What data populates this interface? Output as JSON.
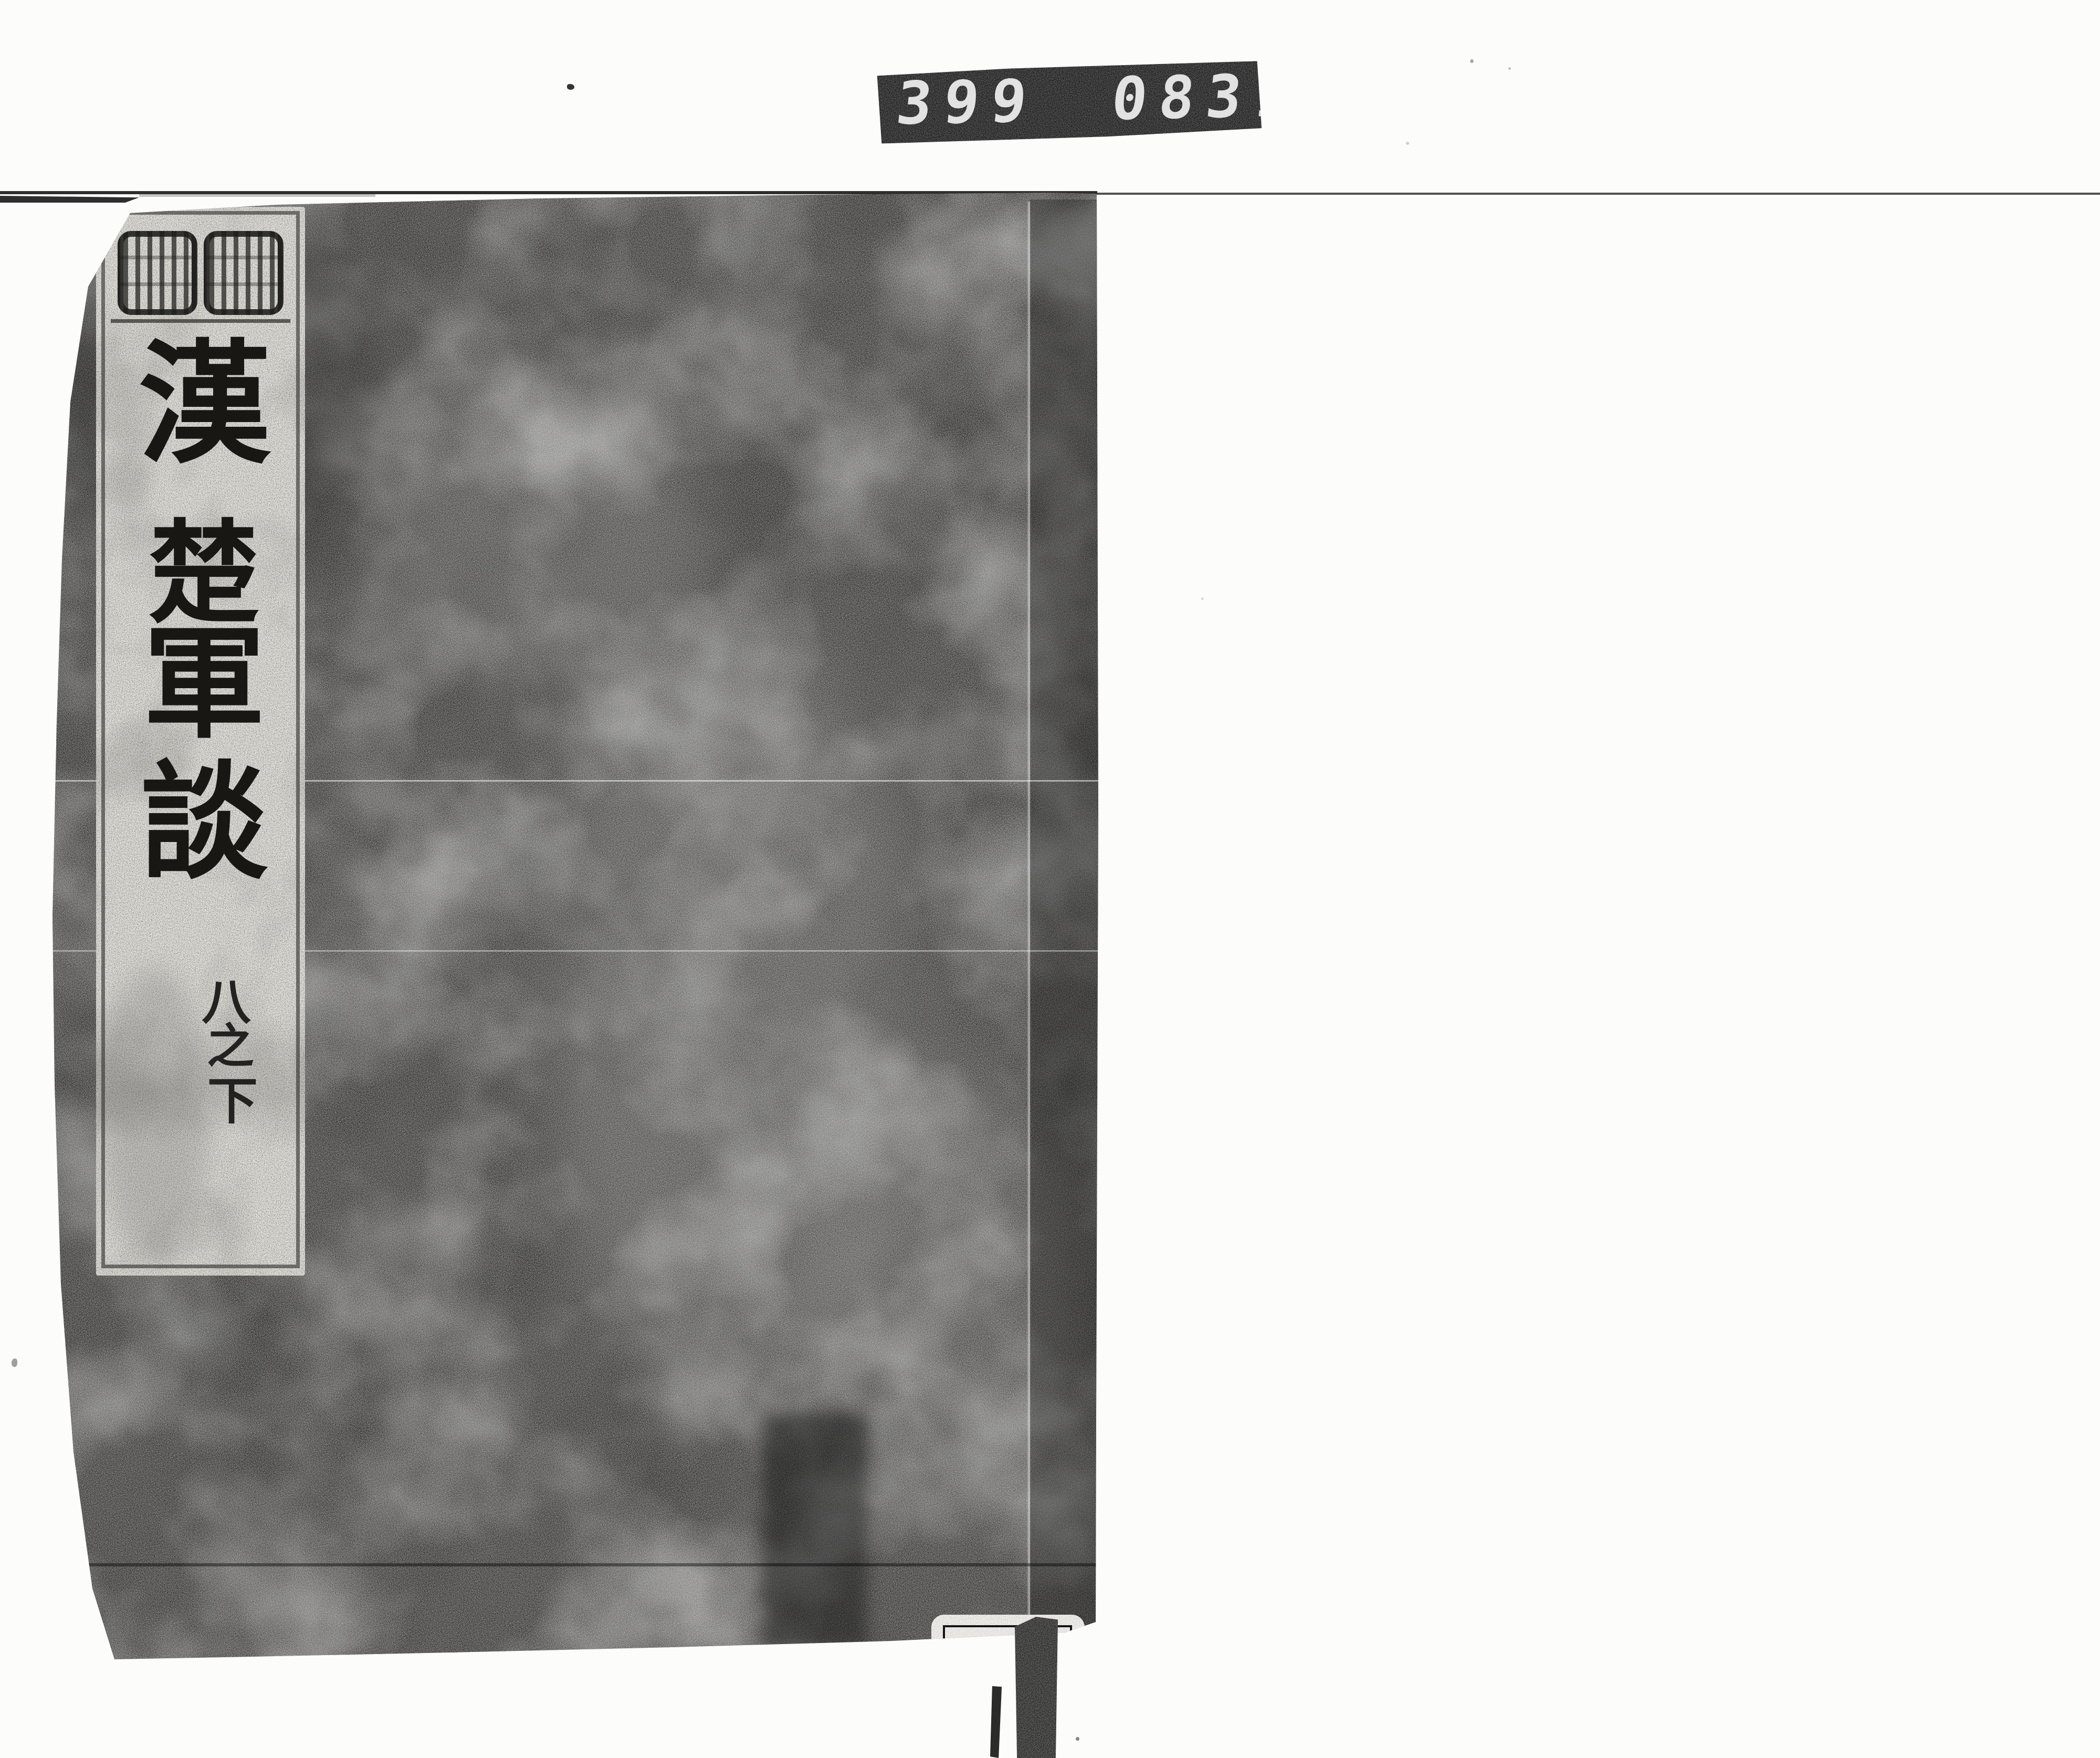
{
  "counter": {
    "left_digits": "399",
    "right_digits": "083",
    "decimal_dot": ".",
    "background": "#121212",
    "digit_color": "#e2e2e2"
  },
  "book": {
    "cover_base_color": "#302f2d",
    "title_slip": {
      "title": "漢楚軍談",
      "title_chars": [
        "漢",
        "楚",
        "軍",
        "談"
      ],
      "volume": "八之下",
      "volume_chars": [
        "八",
        "之",
        "下"
      ],
      "ink_color": "#181714",
      "paper_color": "#eae8e2"
    },
    "call_number_label": {
      "rows": [
        "ナ 4",
        "231",
        "9"
      ],
      "caption": "国文学研究資料館",
      "paper_color": "#f4f2ee"
    }
  }
}
